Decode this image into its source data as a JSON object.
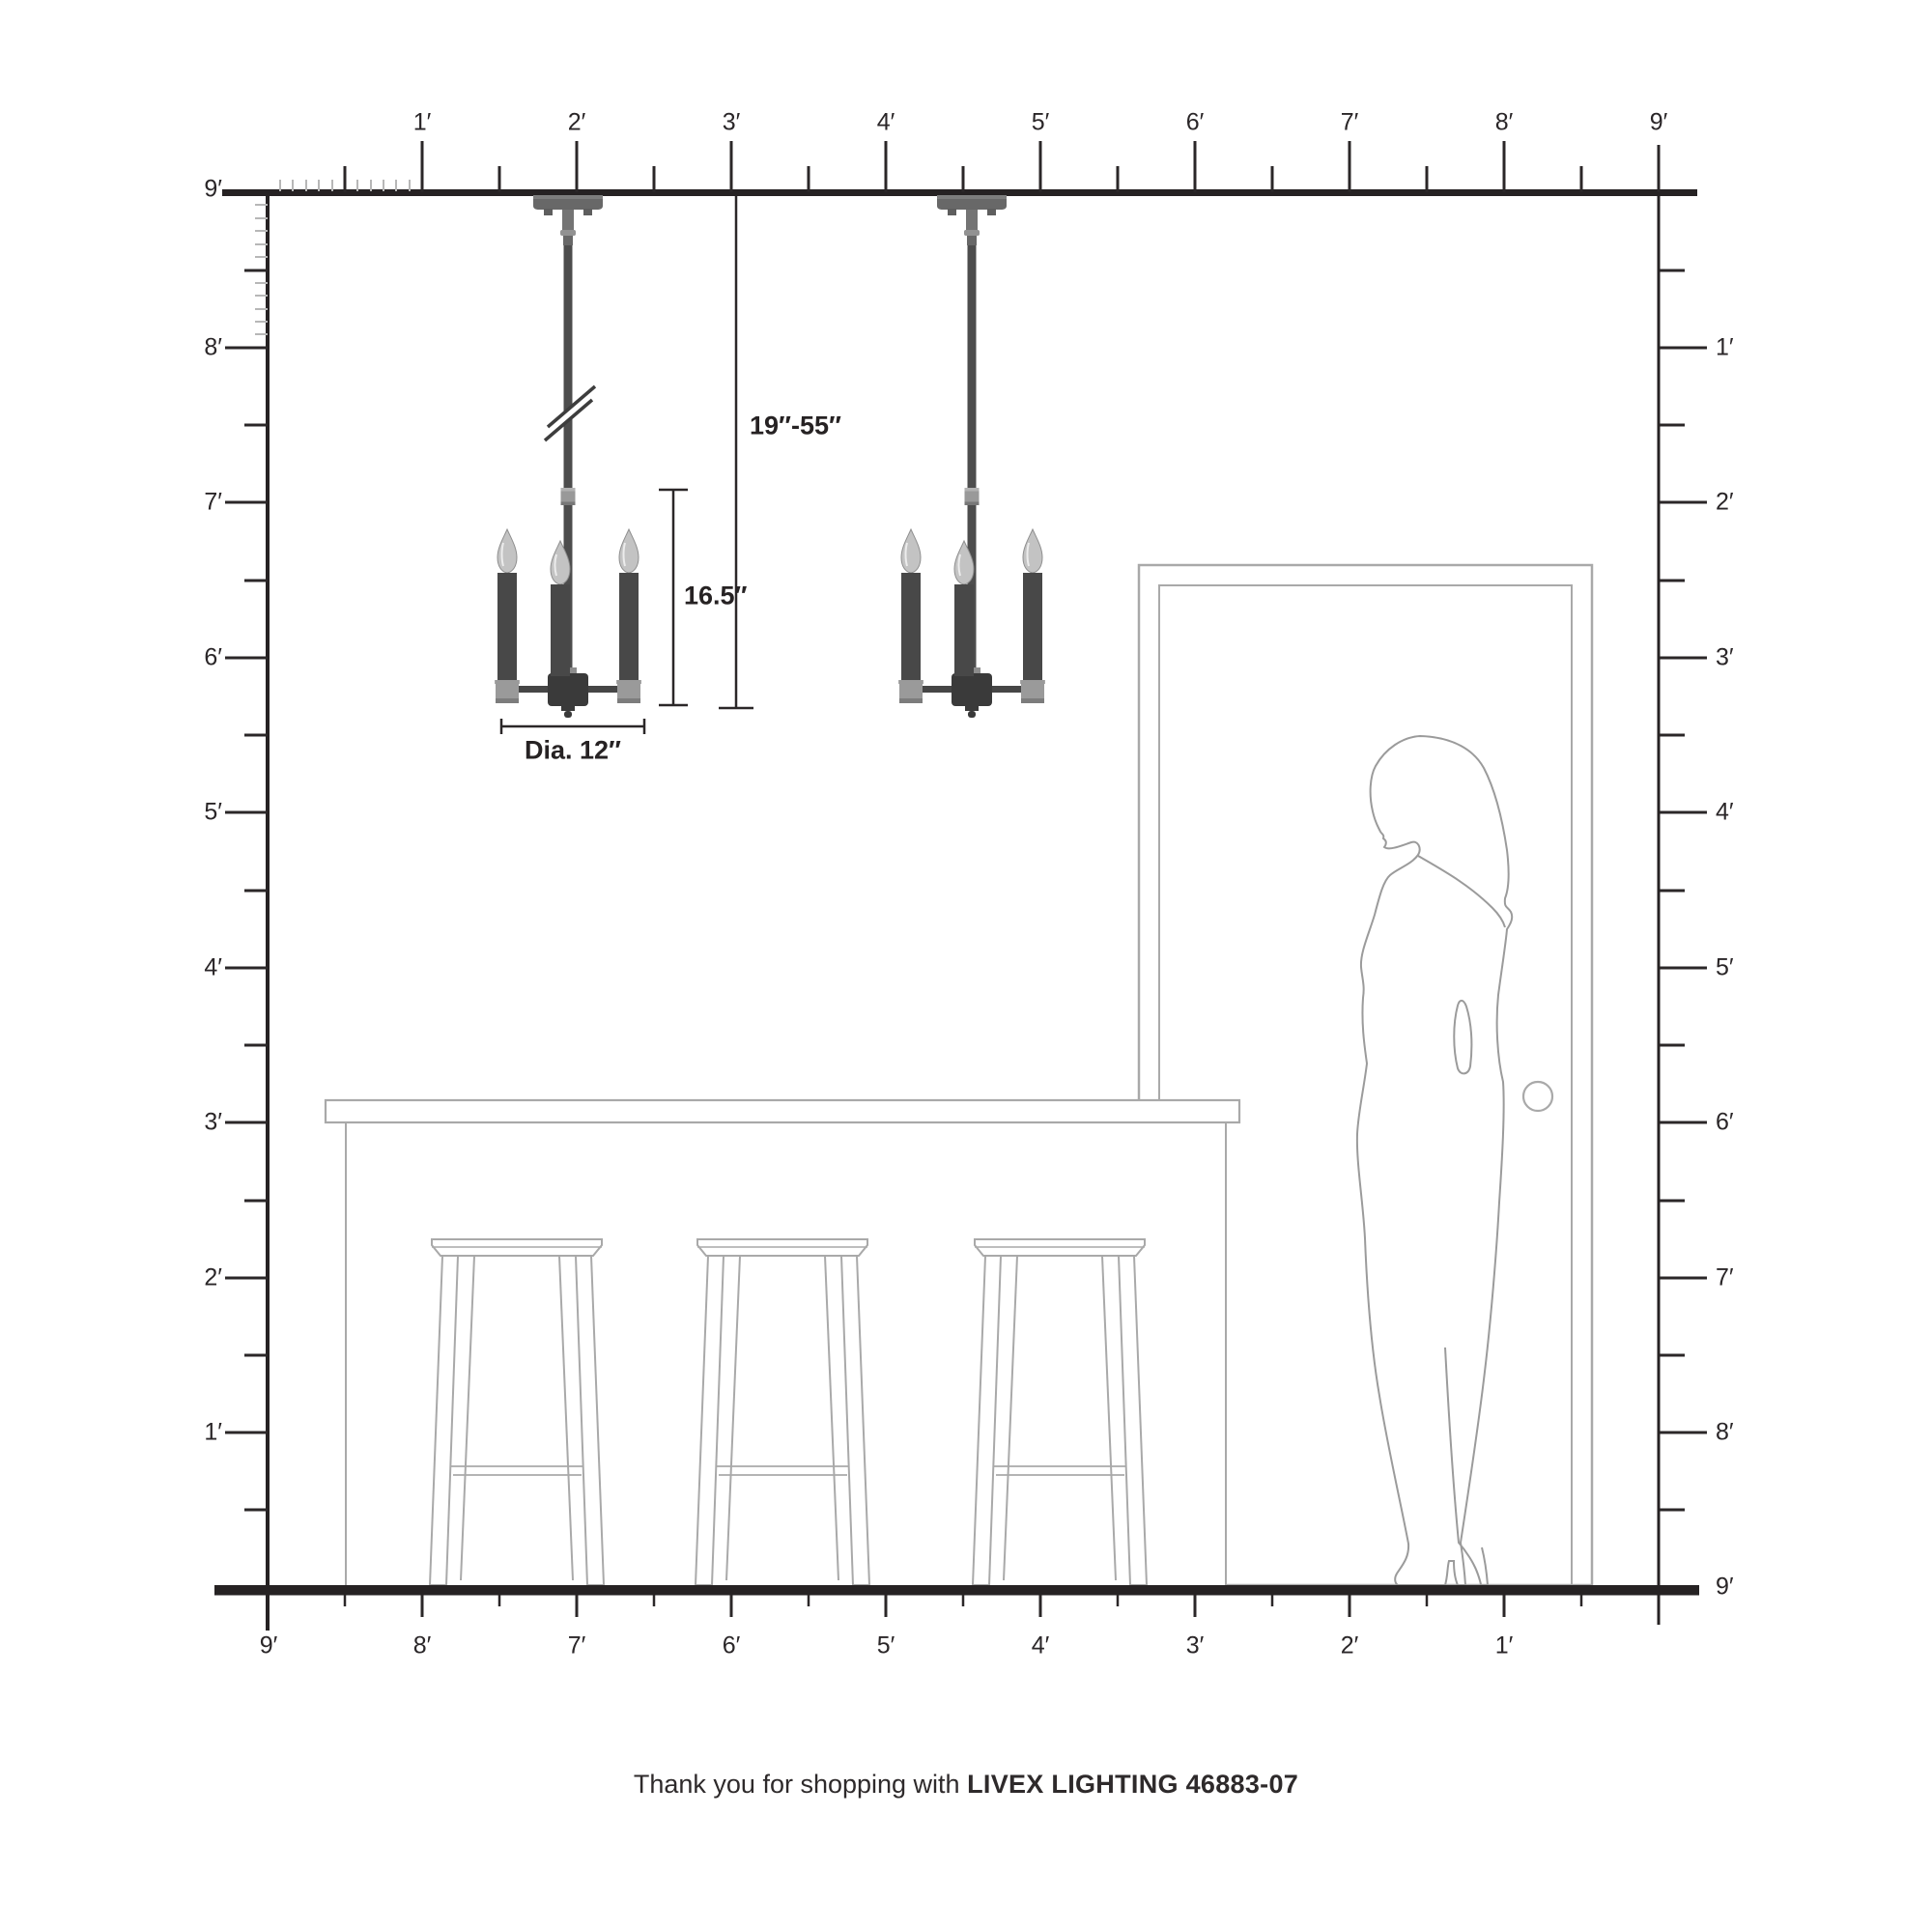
{
  "footer": {
    "regular": "Thank you for shopping with",
    "brand_model": "LIVEX LIGHTING 46883-07"
  },
  "annotations": {
    "hang_range": "19″-55″",
    "fixture_height": "16.5″",
    "fixture_diameter": "Dia. 12″"
  },
  "rulers": {
    "top": [
      "1′",
      "2′",
      "3′",
      "4′",
      "5′",
      "6′",
      "7′",
      "8′",
      "9′"
    ],
    "left": [
      "9′",
      "8′",
      "7′",
      "6′",
      "5′",
      "4′",
      "3′",
      "2′",
      "1′"
    ],
    "right": [
      "1′",
      "2′",
      "3′",
      "4′",
      "5′",
      "6′",
      "7′",
      "8′",
      "9′"
    ],
    "bottom": [
      "9′",
      "8′",
      "7′",
      "6′",
      "5′",
      "4′",
      "3′",
      "2′",
      "1′"
    ]
  },
  "colors": {
    "line_ink": "#262223",
    "outline_light": "#a9a9a9",
    "silhouette_gray": "#9b9b9b",
    "fixture_dark": "#4d4d4d",
    "metal_light": "#999999"
  }
}
